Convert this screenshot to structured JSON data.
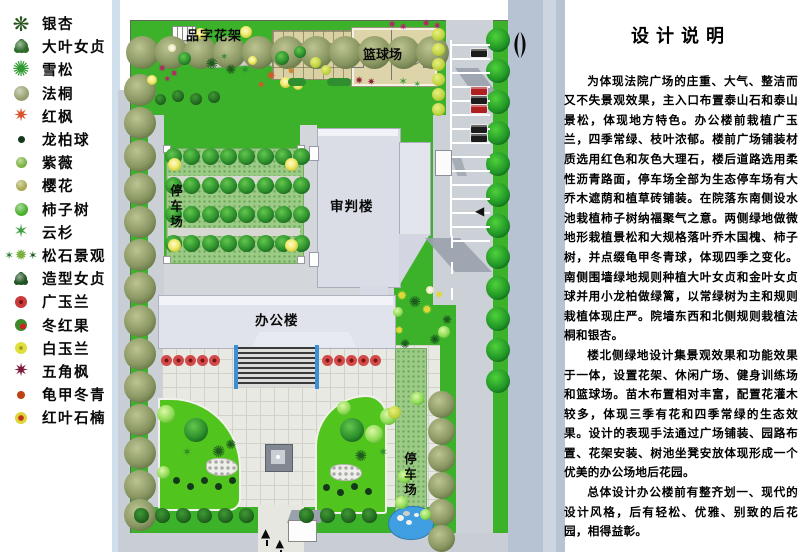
{
  "legend": {
    "items": [
      {
        "label": "银杏",
        "icon": "ginkgo-icon",
        "shape": "burst",
        "color": "#27531c",
        "size": 13
      },
      {
        "label": "大叶女贞",
        "icon": "glossy-privet-icon",
        "shape": "clump",
        "color": "#2c6b28",
        "size": 13
      },
      {
        "label": "雪松",
        "icon": "cedar-icon",
        "shape": "spiky",
        "color": "#2f9a2f",
        "size": 14
      },
      {
        "label": "法桐",
        "icon": "plane-tree-icon",
        "shape": "circle",
        "color": "#95a06e",
        "size": 15
      },
      {
        "label": "红枫",
        "icon": "red-maple-icon",
        "shape": "star",
        "color": "#d9542b",
        "size": 13
      },
      {
        "label": "龙柏球",
        "icon": "dragon-juniper-ball-icon",
        "shape": "dot",
        "color": "#14381a",
        "size": 7
      },
      {
        "label": "紫薇",
        "icon": "crape-myrtle-icon",
        "shape": "circle",
        "color": "#79b23f",
        "size": 11
      },
      {
        "label": "樱花",
        "icon": "cherry-blossom-icon",
        "shape": "circle",
        "color": "#a9a851",
        "size": 11
      },
      {
        "label": "柿子树",
        "icon": "persimmon-tree-icon",
        "shape": "circle",
        "color": "#4ab02b",
        "size": 13
      },
      {
        "label": "云杉",
        "icon": "spruce-icon",
        "shape": "star6",
        "color": "#3f9e3f",
        "size": 13
      },
      {
        "label": "松石景观",
        "icon": "pine-stone-landscape-icon",
        "shape": "cluster",
        "color": "#2e7d32",
        "size": 13
      },
      {
        "label": "造型女贞",
        "icon": "shaped-privet-icon",
        "shape": "clump",
        "color": "#1e521e",
        "size": 12
      },
      {
        "label": "广玉兰",
        "icon": "southern-magnolia-icon",
        "shape": "wheel",
        "color": "#c93a3a",
        "size": 12
      },
      {
        "label": "冬红果",
        "icon": "winter-red-crabapple-icon",
        "shape": "berry",
        "color": "#3c8a28",
        "size": 12
      },
      {
        "label": "白玉兰",
        "icon": "white-magnolia-icon",
        "shape": "wheel-yellow",
        "color": "#dfdf3e",
        "size": 12
      },
      {
        "label": "五角枫",
        "icon": "five-point-maple-icon",
        "shape": "star",
        "color": "#7c1b3a",
        "size": 13
      },
      {
        "label": "龟甲冬青",
        "icon": "tortoiseshell-holly-icon",
        "shape": "dot",
        "color": "#bf4116",
        "size": 8
      },
      {
        "label": "红叶石楠",
        "icon": "red-leaf-photinia-icon",
        "shape": "wheel-red",
        "color": "#ddd53a",
        "size": 12
      }
    ]
  },
  "plan": {
    "labels": {
      "pergola": "品字花架",
      "basketball_court": "篮球场",
      "trial_building": "审判楼",
      "office_building": "办公楼",
      "parking_west": "停车场",
      "parking_southeast": "停车场"
    },
    "colors": {
      "lawn": "#3cb22b",
      "road": "#ccd1d7",
      "street": "#b7c3d2",
      "court": "#ded4a9",
      "building": "#dadde5",
      "water": "#3f9fe0",
      "eco_paving": "#9ccb85",
      "plaza": "#e9e9e3"
    }
  },
  "description": {
    "title": "设计说明",
    "paragraphs": [
      "为体现法院广场的庄重、大气、整洁而又不失景观效果，主入口布置泰山石和泰山景松，体现地方特色。办公楼前栽植广玉兰，四季常绿、枝叶浓郁。楼前广场铺装材质选用红色和灰色大理石，楼后道路选用柔性沥青路面，停车场全部为生态停车场有大乔木遮荫和植草砖铺装。在院落东南侧设水池栽植柿子树纳福聚气之意。两侧绿地做微地形栽植景松和大规格落叶乔木国槐、柿子树，并点缀龟甲冬青球，体现四季之变化。南侧围墙绿地规则种植大叶女贞和金叶女贞球并用小龙柏做绿篱，以常绿树为主和规则栽植体现庄严。院墙东西和北侧规则栽植法桐和银杏。",
      "楼北侧绿地设计集景观效果和功能效果于一体，设置花架、休闲广场、健身训练场和篮球场。苗木布置相对丰富，配置花灌木较多，体现三季有花和四季常绿的生态效果。设计的表现手法通过广场铺装、园路布置、花架安装、树池坐凳安放体现形成一个优美的办公场地后花园。",
      "总体设计办公楼前有整齐划一、现代的设计风格，后有轻松、优雅、别致的后花园，相得益彰。"
    ]
  }
}
